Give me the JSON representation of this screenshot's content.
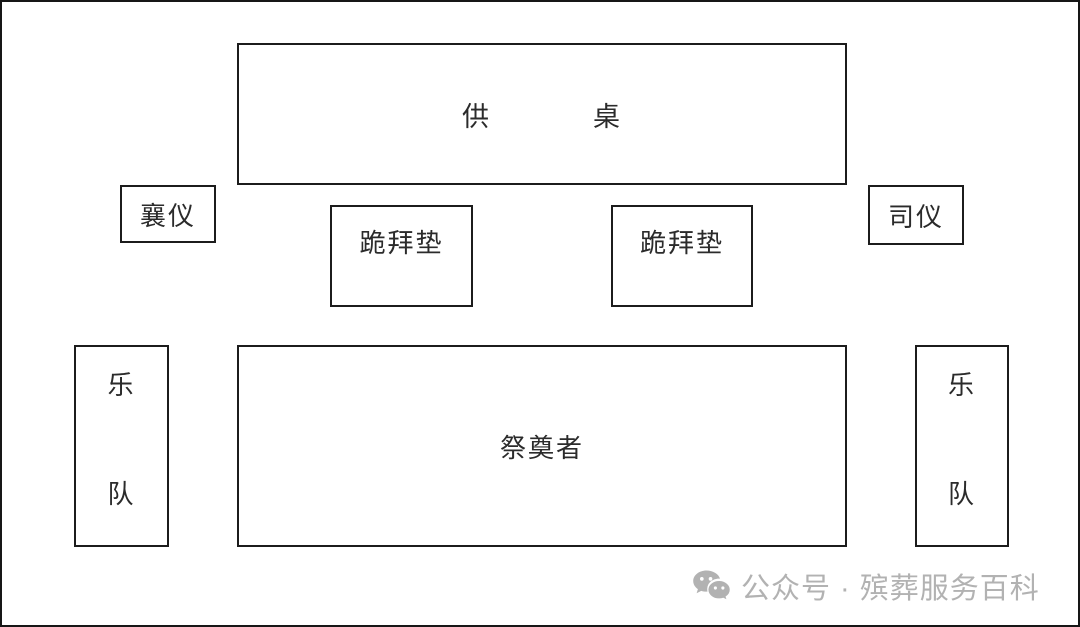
{
  "diagram": {
    "title": "funeral-ceremony-hall-layout",
    "offering_table": {
      "char_left": "供",
      "char_right": "桌"
    },
    "xiangyi": {
      "label": "襄仪"
    },
    "siyi": {
      "label": "司仪"
    },
    "kneeling_mat_left": {
      "label": "跪拜垫"
    },
    "kneeling_mat_right": {
      "label": "跪拜垫"
    },
    "mourners": {
      "label": "祭奠者"
    },
    "band_left": {
      "char_top": "乐",
      "char_bottom": "队"
    },
    "band_right": {
      "char_top": "乐",
      "char_bottom": "队"
    }
  },
  "watermark": {
    "icon": "wechat-icon",
    "text": "公众号 · 殡葬服务百科"
  },
  "colors": {
    "background": "#ffffff",
    "border": "#1c1c1c",
    "label_text": "#2b2b2b",
    "watermark_gray": "#b2b2b2"
  }
}
